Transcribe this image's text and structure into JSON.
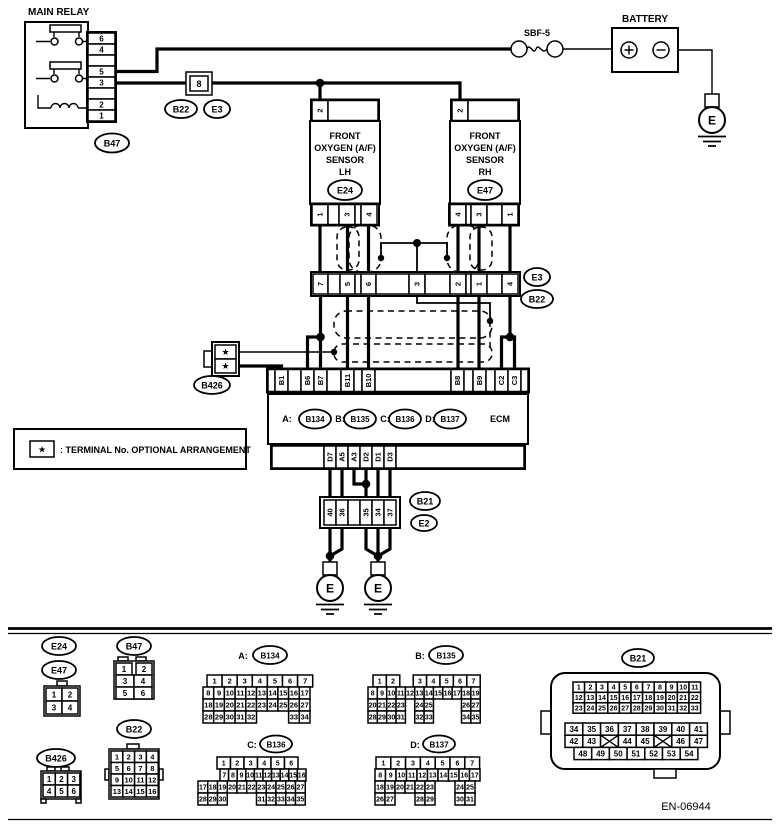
{
  "diagram": {
    "main_relay": {
      "title": "MAIN RELAY",
      "pins": [
        "6",
        "4",
        "",
        "5",
        "3",
        "",
        "2",
        "1"
      ],
      "tag": "B47"
    },
    "fuse": {
      "label": "SBF-5"
    },
    "battery": {
      "title": "BATTERY"
    },
    "inline8": {
      "label": "8",
      "tag1": "B22",
      "tag2": "E3"
    },
    "sensor_lh": {
      "l1": "FRONT",
      "l2": "OXYGEN (A/F)",
      "l3": "SENSOR",
      "l4": "LH",
      "tag": "E24",
      "top_pins": [
        "2",
        ""
      ],
      "bottom_pins": [
        "1",
        "",
        "3",
        "",
        "4"
      ]
    },
    "sensor_rh": {
      "l1": "FRONT",
      "l2": "OXYGEN (A/F)",
      "l3": "SENSOR",
      "l4": "RH",
      "tag": "E47",
      "top_pins": [
        "2",
        ""
      ],
      "bottom_pins": [
        "4",
        "",
        "3",
        "",
        "1"
      ]
    },
    "mid_row": {
      "pins": [
        "7",
        "",
        "5",
        "",
        "6",
        "",
        "3",
        "",
        "2",
        "",
        "1",
        "",
        "4"
      ],
      "tag1": "E3",
      "tag2": "B22"
    },
    "b426": {
      "tag": "B426",
      "pins": [
        "★",
        "★"
      ]
    },
    "ecm": {
      "top_pins": [
        "",
        "B1",
        "",
        "B6",
        "B7",
        "",
        "B11",
        "",
        "B10",
        "",
        "B8",
        "",
        "B9",
        "",
        "C2",
        "C3",
        ""
      ],
      "a_label": "A:",
      "a": "B134",
      "b_label": "B:",
      "b": "B135",
      "c_label": "C:",
      "c": "B136",
      "d_label": "D:",
      "d": "B137",
      "name": "ECM",
      "bottom_pins": [
        "",
        "D7",
        "A5",
        "A3",
        "D2",
        "D1",
        "D3",
        ""
      ]
    },
    "b21_row": {
      "pins": [
        "40",
        "36",
        "",
        "35",
        "34",
        "37"
      ],
      "tag1": "B21",
      "tag2": "E2"
    },
    "ground": "E",
    "legend": {
      "star": "★",
      "text": ": TERMINAL No. OPTIONAL ARRANGEMENT"
    },
    "doc_no": "EN-06944"
  },
  "pinouts": {
    "e24": "E24",
    "e47": "E47",
    "e24e47_rows": [
      [
        "1",
        "2"
      ],
      [
        "3",
        "4"
      ]
    ],
    "b47": "B47",
    "b47_rows": [
      [
        "1",
        "2"
      ],
      [
        "3",
        "4"
      ],
      [
        "5",
        "6"
      ]
    ],
    "b426": "B426",
    "b426_rows": [
      [
        "1",
        "2",
        "3"
      ],
      [
        "4",
        "5",
        "6"
      ]
    ],
    "b22": "B22",
    "b22_rows": [
      [
        "1",
        "2",
        "3",
        "4"
      ],
      [
        "5",
        "6",
        "7",
        "8"
      ],
      [
        "9",
        "10",
        "11",
        "12"
      ],
      [
        "13",
        "14",
        "15",
        "16"
      ]
    ],
    "b134_label": "A:",
    "b134": "B134",
    "b134_rows": [
      [
        "1",
        "2",
        "3",
        "4",
        "5",
        "6",
        "7"
      ],
      [
        "8",
        "9",
        "10",
        "11",
        "12",
        "13",
        "14",
        "15",
        "16",
        "17"
      ],
      [
        "18",
        "19",
        "20",
        "21",
        "22",
        "23",
        "24",
        "25",
        "26",
        "27"
      ],
      [
        "28",
        "29",
        "30",
        "31",
        "32",
        "",
        "",
        "",
        "33",
        "34"
      ]
    ],
    "b135_label": "B:",
    "b135": "B135",
    "b135_rows": [
      [
        "1",
        "2",
        "",
        "3",
        "4",
        "5",
        "6",
        "7"
      ],
      [
        "8",
        "9",
        "10",
        "11",
        "12",
        "13",
        "14",
        "15",
        "16",
        "17",
        "18",
        "19"
      ],
      [
        "20",
        "21",
        "22",
        "23",
        "",
        "24",
        "25",
        "",
        "",
        "",
        "26",
        "27"
      ],
      [
        "28",
        "29",
        "30",
        "31",
        "",
        "32",
        "33",
        "",
        "",
        "",
        "34",
        "35"
      ]
    ],
    "b136_label": "C:",
    "b136": "B136",
    "b136_rows": [
      [
        "1",
        "2",
        "3",
        "4",
        "5",
        "6"
      ],
      [
        "7",
        "8",
        "9",
        "10",
        "11",
        "12",
        "13",
        "14",
        "15",
        "16"
      ],
      [
        "17",
        "18",
        "19",
        "20",
        "21",
        "22",
        "23",
        "24",
        "25",
        "26",
        "27"
      ],
      [
        "28",
        "29",
        "30",
        "",
        "",
        "",
        "31",
        "32",
        "33",
        "34",
        "35"
      ]
    ],
    "b137_label": "D:",
    "b137": "B137",
    "b137_rows": [
      [
        "1",
        "2",
        "3",
        "4",
        "5",
        "6",
        "7"
      ],
      [
        "8",
        "9",
        "10",
        "11",
        "12",
        "13",
        "14",
        "15",
        "16",
        "17"
      ],
      [
        "18",
        "19",
        "20",
        "21",
        "22",
        "23",
        "",
        "",
        "24",
        "25"
      ],
      [
        "26",
        "27",
        "",
        "",
        "28",
        "29",
        "",
        "",
        "30",
        "31"
      ]
    ],
    "b21": "B21",
    "b21_top_rows": [
      [
        "1",
        "2",
        "3",
        "4",
        "5",
        "6",
        "7",
        "8",
        "9",
        "10",
        "11"
      ],
      [
        "12",
        "13",
        "14",
        "15",
        "16",
        "17",
        "18",
        "19",
        "20",
        "21",
        "22"
      ],
      [
        "23",
        "24",
        "25",
        "26",
        "27",
        "28",
        "29",
        "30",
        "31",
        "32",
        "33"
      ]
    ],
    "b21_bottom_rows": [
      [
        "34",
        "35",
        "36",
        "37",
        "38",
        "39",
        "40",
        "41"
      ],
      [
        "42",
        "43",
        "X",
        "44",
        "45",
        "X",
        "46",
        "47"
      ],
      [
        "48",
        "49",
        "50",
        "51",
        "52",
        "53",
        "54"
      ]
    ]
  }
}
